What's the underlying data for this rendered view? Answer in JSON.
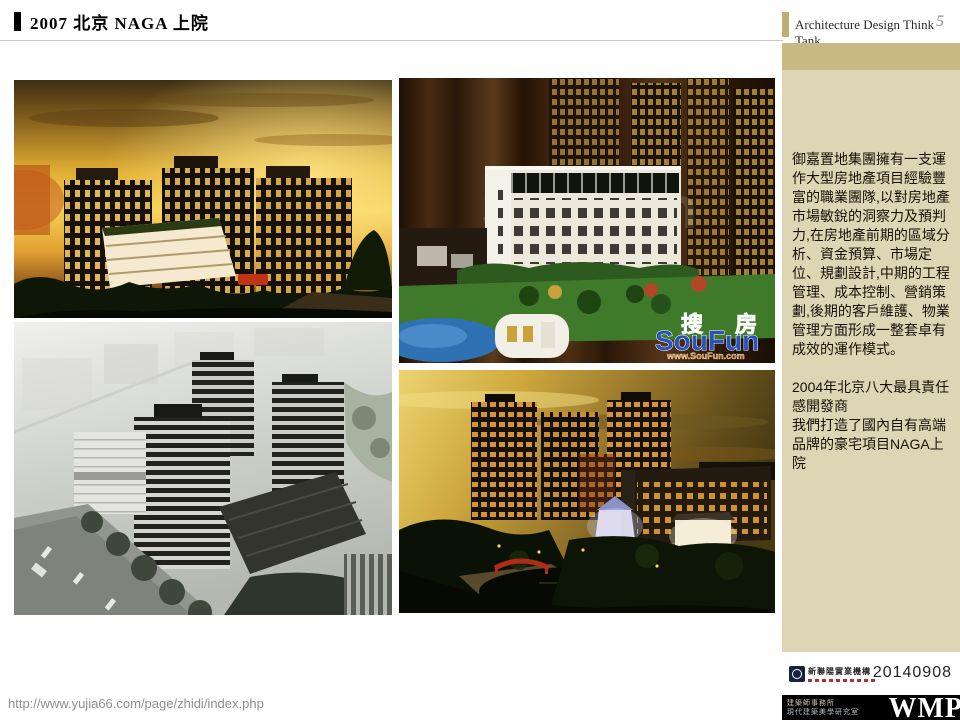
{
  "header": {
    "title": "2007 北京 NAGA 上院",
    "think_tank_label": "Architecture Design Think Tank",
    "page_number": "5"
  },
  "sidebar": {
    "intro": "御嘉置地集團擁有一支運作大型房地產項目經驗豐富的職業團隊,以對房地產市場敏銳的洞察力及預判力,在房地產前期的區域分析、資金預算、市場定位、規劃設計,中期的工程管理、成本控制、營銷策劃,後期的客戶維護、物業管理方面形成一整套卓有成效的運作模式。",
    "award_line": "2004年北京八大最具責任感開發商",
    "brand_line": "我們打造了國內自有高端品牌的豪宅項目NAGA上院"
  },
  "footer": {
    "url": "http://www.yujia66.com/page/zhidi/index.php",
    "date": "20140908",
    "company_name": "新聯陽實業機構",
    "studio_line1": "建築師事務所",
    "studio_line2": "現代建築美學研究室",
    "wmp": "WMP"
  },
  "watermark": {
    "soufun_cn_1": "搜",
    "soufun_cn_2": "房",
    "soufun_en": "SouFun",
    "soufun_url": "www.SouFun.com"
  },
  "colors": {
    "sidebar_band": "#c9b985",
    "sidebar_bg": "#ded5b4",
    "header_accent": "#bfae74",
    "soufun_blue": "#2b52b8",
    "soufun_orange": "#e07818",
    "strip_black": "#000000"
  }
}
